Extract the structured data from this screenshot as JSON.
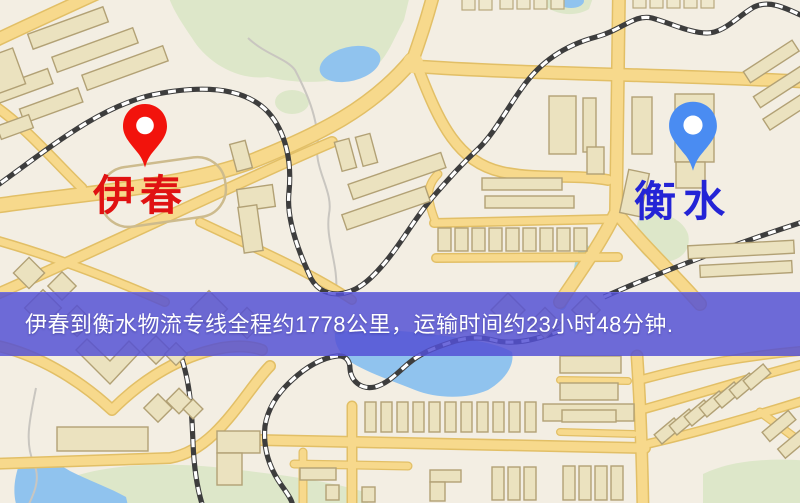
{
  "map": {
    "banner": {
      "text": "伊春到衡水物流专线全程约1778公里，运输时间约23小时48分钟.",
      "bg_color": "#5350d4",
      "text_color": "#ffffff"
    },
    "markers": [
      {
        "id": "origin",
        "label": "伊春",
        "pin_color": "#f2130c",
        "pin_hole_color": "#ffffff",
        "label_color": "#e01212",
        "position": "top-left"
      },
      {
        "id": "destination",
        "label": "衡水",
        "pin_color": "#4a8cf2",
        "pin_hole_color": "#ffffff",
        "label_color": "#2424d6",
        "position": "top-right"
      }
    ],
    "colors": {
      "land": "#f3eee3",
      "park": "#dde7c9",
      "water": "#90c3ee",
      "road_fill": "#f7d98c",
      "road_casing": "#e2bf66",
      "building": "#ebe2bf",
      "building_outline": "#b2a175",
      "railway": "#3d3d3d"
    }
  }
}
